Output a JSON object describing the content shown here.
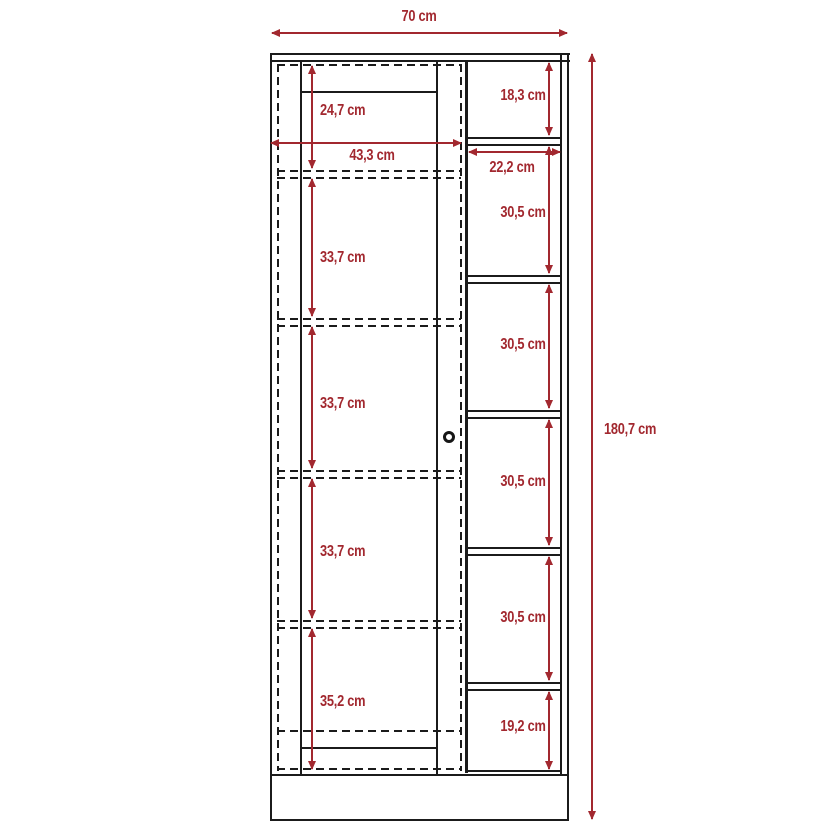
{
  "diagram_type": "furniture-dimension-drawing",
  "colors": {
    "dimension_red": "#a2282f",
    "line_black": "#1b1b1b",
    "background": "#ffffff"
  },
  "dimensions": {
    "overall_width": "70 cm",
    "overall_height": "180,7 cm",
    "door_inner_width": "43,3 cm",
    "door_sections": [
      "24,7 cm",
      "33,7 cm",
      "33,7 cm",
      "33,7 cm",
      "35,2 cm"
    ],
    "shelf_inner_width": "22,2 cm",
    "shelf_sections": [
      "18,3 cm",
      "30,5 cm",
      "30,5 cm",
      "30,5 cm",
      "30,5 cm",
      "19,2 cm"
    ]
  }
}
